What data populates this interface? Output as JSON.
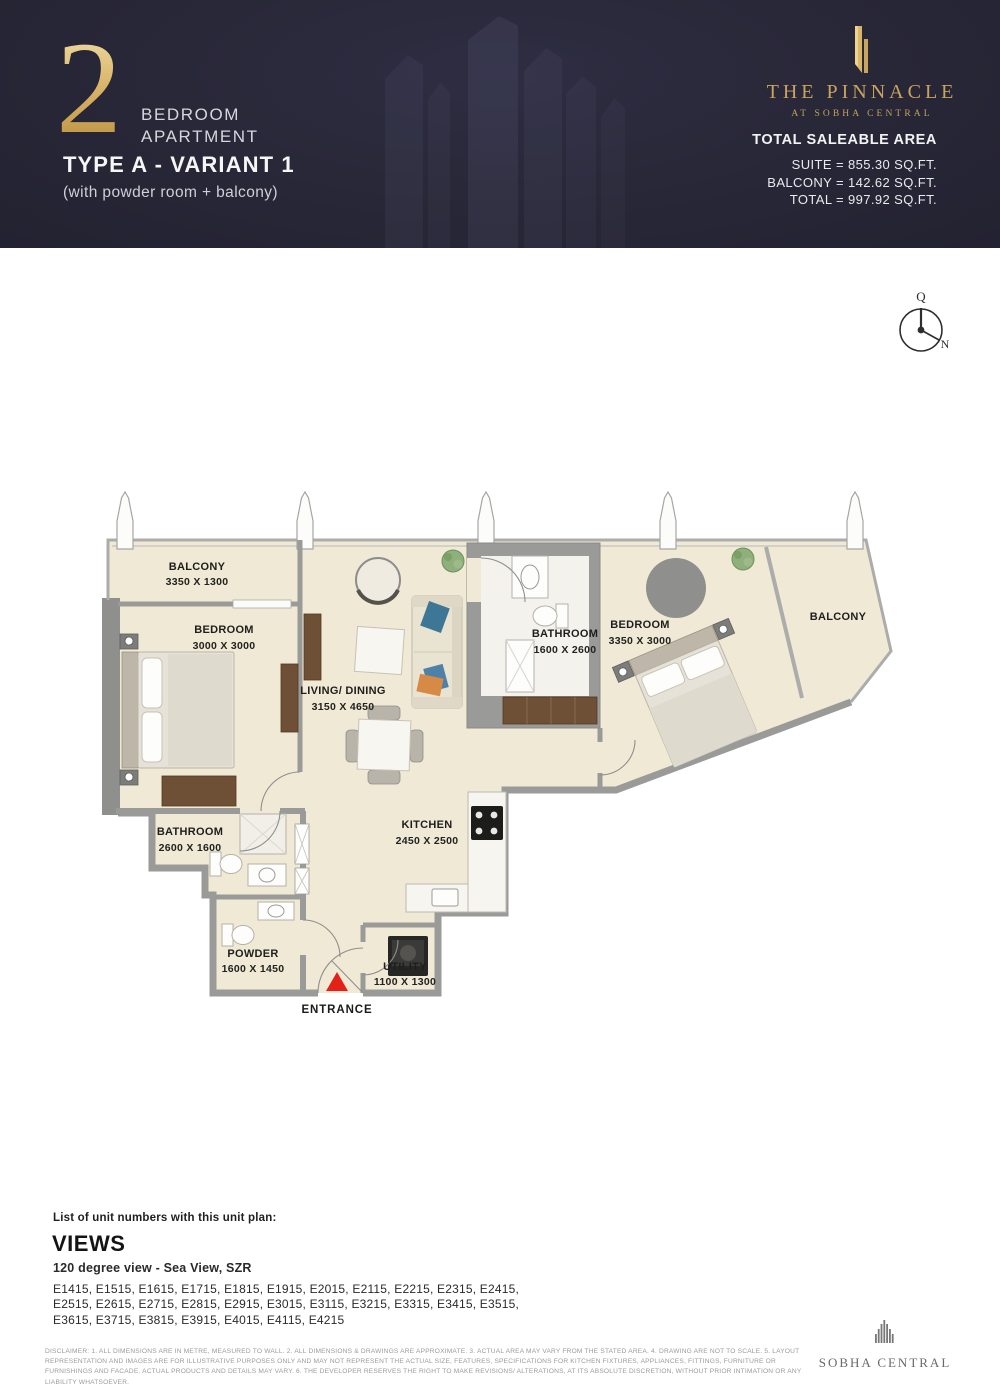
{
  "header": {
    "unit_number": "2",
    "unit_type_line1": "BEDROOM",
    "unit_type_line2": "APARTMENT",
    "variant_title": "TYPE A - VARIANT 1",
    "variant_subtitle": "(with powder room + balcony)",
    "brand_name": "THE PINNACLE",
    "brand_tagline": "AT SOBHA CENTRAL",
    "area_title": "TOTAL SALEABLE AREA",
    "area_suite": "SUITE = 855.30 SQ.FT.",
    "area_balcony": "BALCONY = 142.62 SQ.FT.",
    "area_total": "TOTAL = 997.92 SQ.FT.",
    "colors": {
      "background": "#282737",
      "gold": "#C9A45F",
      "text": "#F3F3F5"
    }
  },
  "compass": {
    "qibla": "Q",
    "north": "N"
  },
  "floorplan": {
    "colors": {
      "floor": "#F0E9D5",
      "wall": "#9A9A98",
      "wood": "#6E5036",
      "entrance_arrow": "#E32119"
    },
    "rooms": {
      "balcony_left": {
        "name": "BALCONY",
        "dims": "3350 X 1300"
      },
      "bedroom_left": {
        "name": "BEDROOM",
        "dims": "3000 X 3000"
      },
      "living": {
        "name": "LIVING/ DINING",
        "dims": "3150 X 4650"
      },
      "bathroom_center": {
        "name": "BATHROOM",
        "dims": "1600 X 2600"
      },
      "bedroom_right": {
        "name": "BEDROOM",
        "dims": "3350 X 3000"
      },
      "balcony_right": {
        "name": "BALCONY"
      },
      "bathroom_left": {
        "name": "BATHROOM",
        "dims": "2600 X 1600"
      },
      "kitchen": {
        "name": "KITCHEN",
        "dims": "2450 X 2500"
      },
      "powder": {
        "name": "POWDER",
        "dims": "1600 X 1450"
      },
      "utility": {
        "name": "UTILITY",
        "dims": "1100 X 1300"
      }
    },
    "entrance_label": "ENTRANCE"
  },
  "footer": {
    "list_title": "List of unit numbers with this unit plan:",
    "views_title": "VIEWS",
    "views_description": "120 degree view - Sea View, SZR",
    "unit_numbers": "E1415, E1515, E1615, E1715, E1815, E1915, E2015, E2115, E2215, E2315, E2415, E2515, E2615, E2715, E2815, E2915, E3015, E3115, E3215, E3315, E3415, E3515, E3615, E3715, E3815, E3915, E4015, E4115, E4215",
    "disclaimer": "DISCLAIMER: 1. ALL DIMENSIONS ARE IN METRE, MEASURED TO WALL. 2. ALL DIMENSIONS & DRAWINGS ARE APPROXIMATE. 3. ACTUAL AREA MAY VARY FROM THE STATED AREA. 4. DRAWING ARE NOT TO SCALE. 5. LAYOUT REPRESENTATION AND IMAGES ARE FOR ILLUSTRATIVE PURPOSES ONLY AND MAY NOT REPRESENT THE ACTUAL SIZE, FEATURES, SPECIFICATIONS FOR KITCHEN FIXTURES, APPLIANCES, FITTINGS, FURNITURE OR FURNISHINGS AND FACADE. ACTUAL PRODUCTS AND DETAILS MAY VARY. 6. THE DEVELOPER RESERVES THE RIGHT TO MAKE REVISIONS/ ALTERATIONS, AT ITS ABSOLUTE DISCRETION, WITHOUT PRIOR INTIMATION OR ANY LIABILITY WHATSOEVER.",
    "brand_name": "SOBHA CENTRAL"
  }
}
